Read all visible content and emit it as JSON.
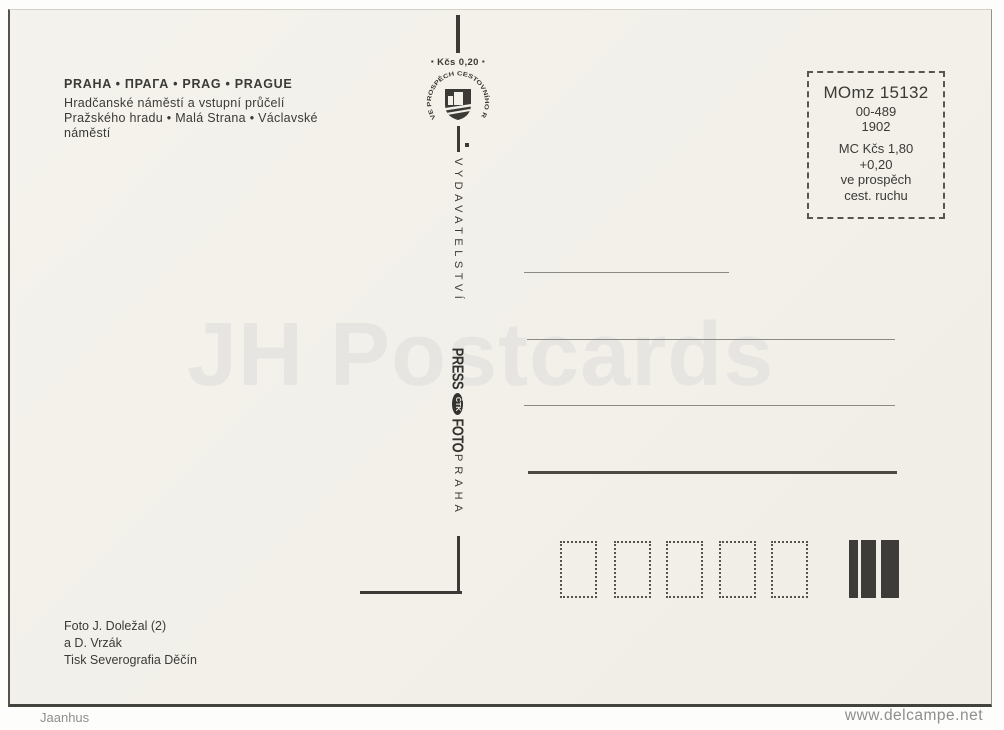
{
  "postcard": {
    "title": "PRAHA • ПРАГА • PRAG • PRAGUE",
    "subtitle": [
      "Hradčanské náměstí a vstupní průčelí",
      "Pražského hradu • Malá Strana • Václavské",
      "náměstí"
    ],
    "divider": {
      "price": "Kčs 0,20",
      "emblem_text": "VE PROSPĚCH CESTOVNÍHO RUCHU",
      "publisher": "VYDAVATELSTVÍ",
      "logo_press": "PRESS",
      "logo_ctk": "ČTK",
      "logo_foto": "FOTO",
      "city": "PRAHA"
    },
    "stamp_box": {
      "code": "MOmz 15132",
      "line2": "00-489",
      "line3": "1902",
      "line4": "MC Kčs 1,80",
      "line5": "+0,20",
      "line6": "ve prospěch",
      "line7": "cest. ruchu"
    },
    "credits": [
      "Foto J. Doležal (2)",
      "a D. Vrzák",
      "Tisk Severografia Děčín"
    ],
    "watermark": "JH Postcards",
    "postal_code_box_count": 5
  },
  "footer": {
    "left": "Jaanhus",
    "right": "www.delcampe.net"
  },
  "icons": {
    "square_bullet": "▪"
  },
  "colors": {
    "paper": "#f2f0e9",
    "ink": "#3c3a36",
    "watermark": "#e7e5e1",
    "address_line": "#8b8b85"
  }
}
